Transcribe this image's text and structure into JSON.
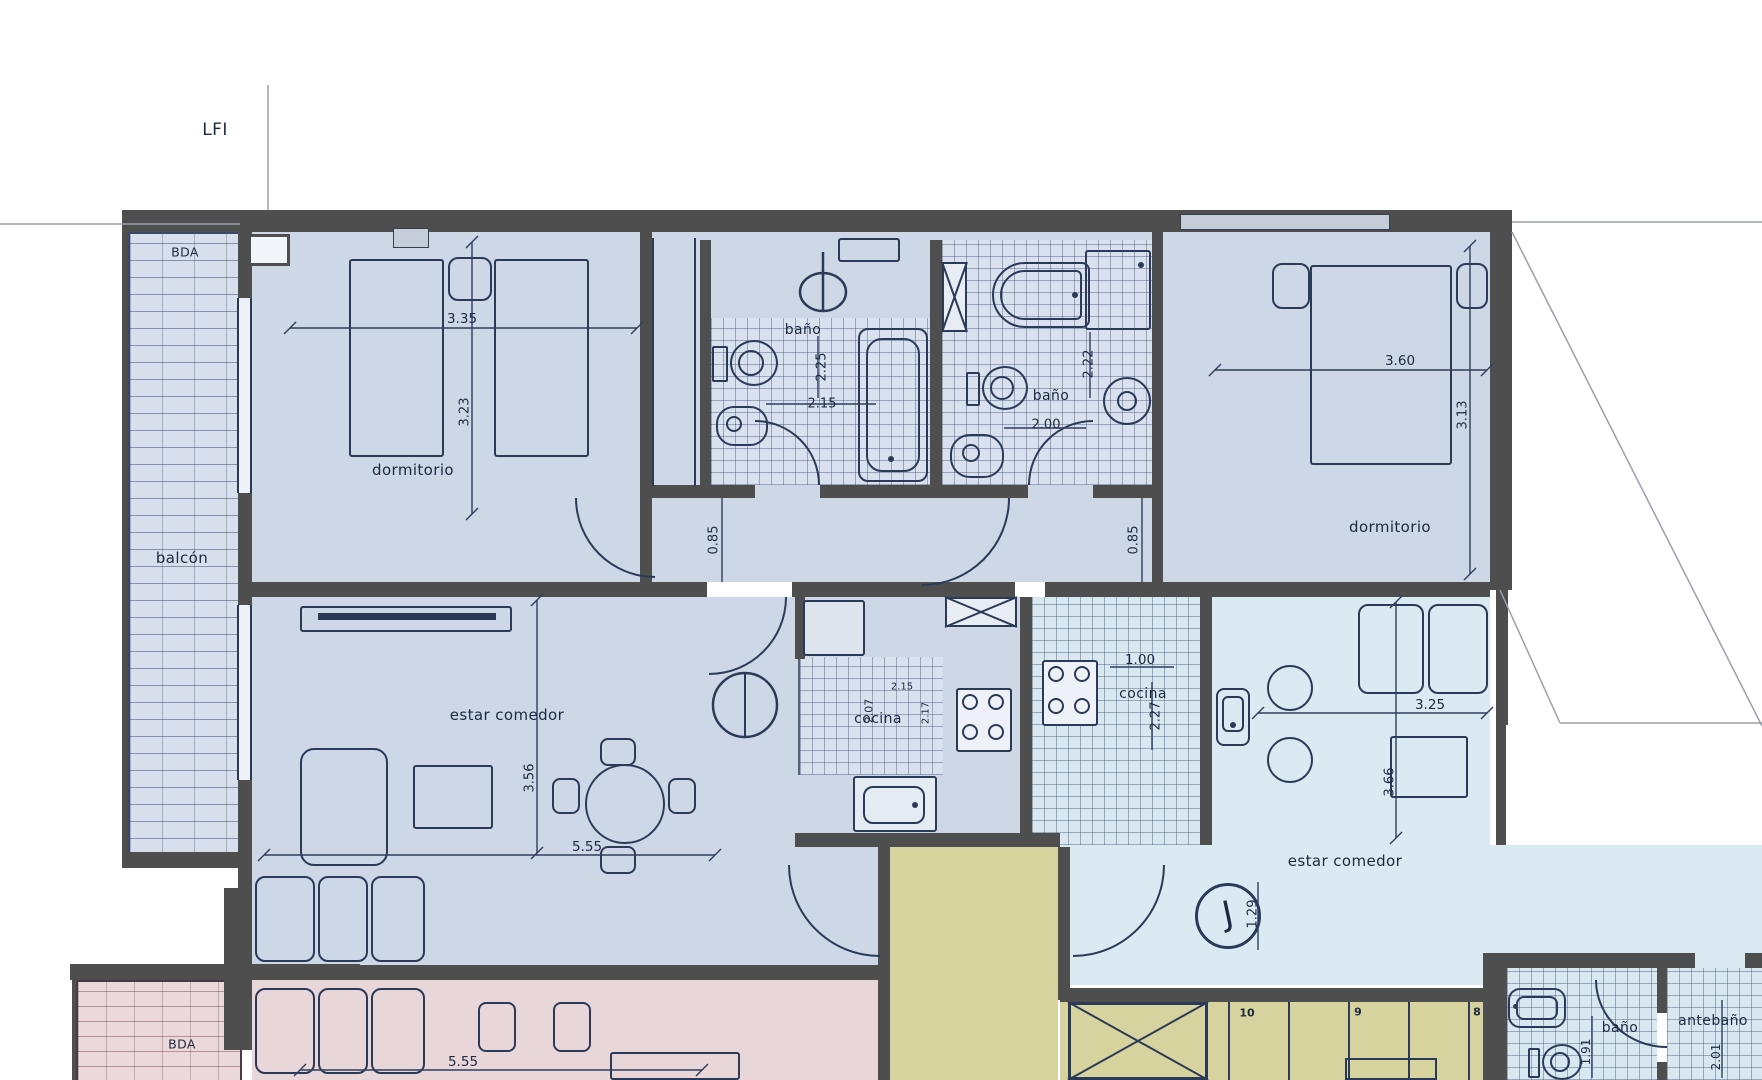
{
  "site": {
    "boundary_label": "LFI"
  },
  "labels": {
    "balcony_top_code": "BDA",
    "balcony_top": "balcón",
    "bedroom_left": "dormitorio",
    "bedroom_right": "dormitorio",
    "bathroom_1": "baño",
    "bathroom_2": "baño",
    "bathroom_3": "baño",
    "ante_bathroom": "antebaño",
    "living_left": "estar comedor",
    "living_right": "estar comedor",
    "kitchen_left": "cocina",
    "kitchen_right": "cocina",
    "balcony_bottom_code": "BDA",
    "laundry_symbol": "J"
  },
  "dimensions": {
    "bedroom_left_width": "3.35",
    "bedroom_left_depth": "3.23",
    "bathroom_1_depth": "2.25",
    "bathroom_1_width": "2.15",
    "bathroom_2_depth": "2.22",
    "bathroom_2_width": "2.00",
    "bedroom_right_width": "3.60",
    "bedroom_right_depth": "3.13",
    "hall_left_width": "0.85",
    "hall_right_width": "0.85",
    "living_left_depth": "3.56",
    "living_left_width": "5.55",
    "kitchen_left_width": "2.15",
    "kitchen_left_depth": "2.07",
    "kitchen_left_depth_2": "2.17",
    "kitchen_right_width": "1.00",
    "kitchen_right_depth": "2.27",
    "living_right_width": "3.25",
    "living_right_depth": "3.66",
    "entry_right_width": "1.29",
    "living_lower_width": "5.55",
    "bathroom_3_width": "1.91",
    "ante_bathroom_width": "2.01"
  },
  "stairs": {
    "step_numbers": [
      "10",
      "9",
      "8"
    ]
  },
  "colors": {
    "wall": "#4e4e4e",
    "unit_left": "#cdd7e6",
    "unit_right": "#dbeaf2",
    "unit_lower": "#e9d6d9",
    "common_hall": "#d7d39e",
    "linework": "#2b3b57"
  }
}
